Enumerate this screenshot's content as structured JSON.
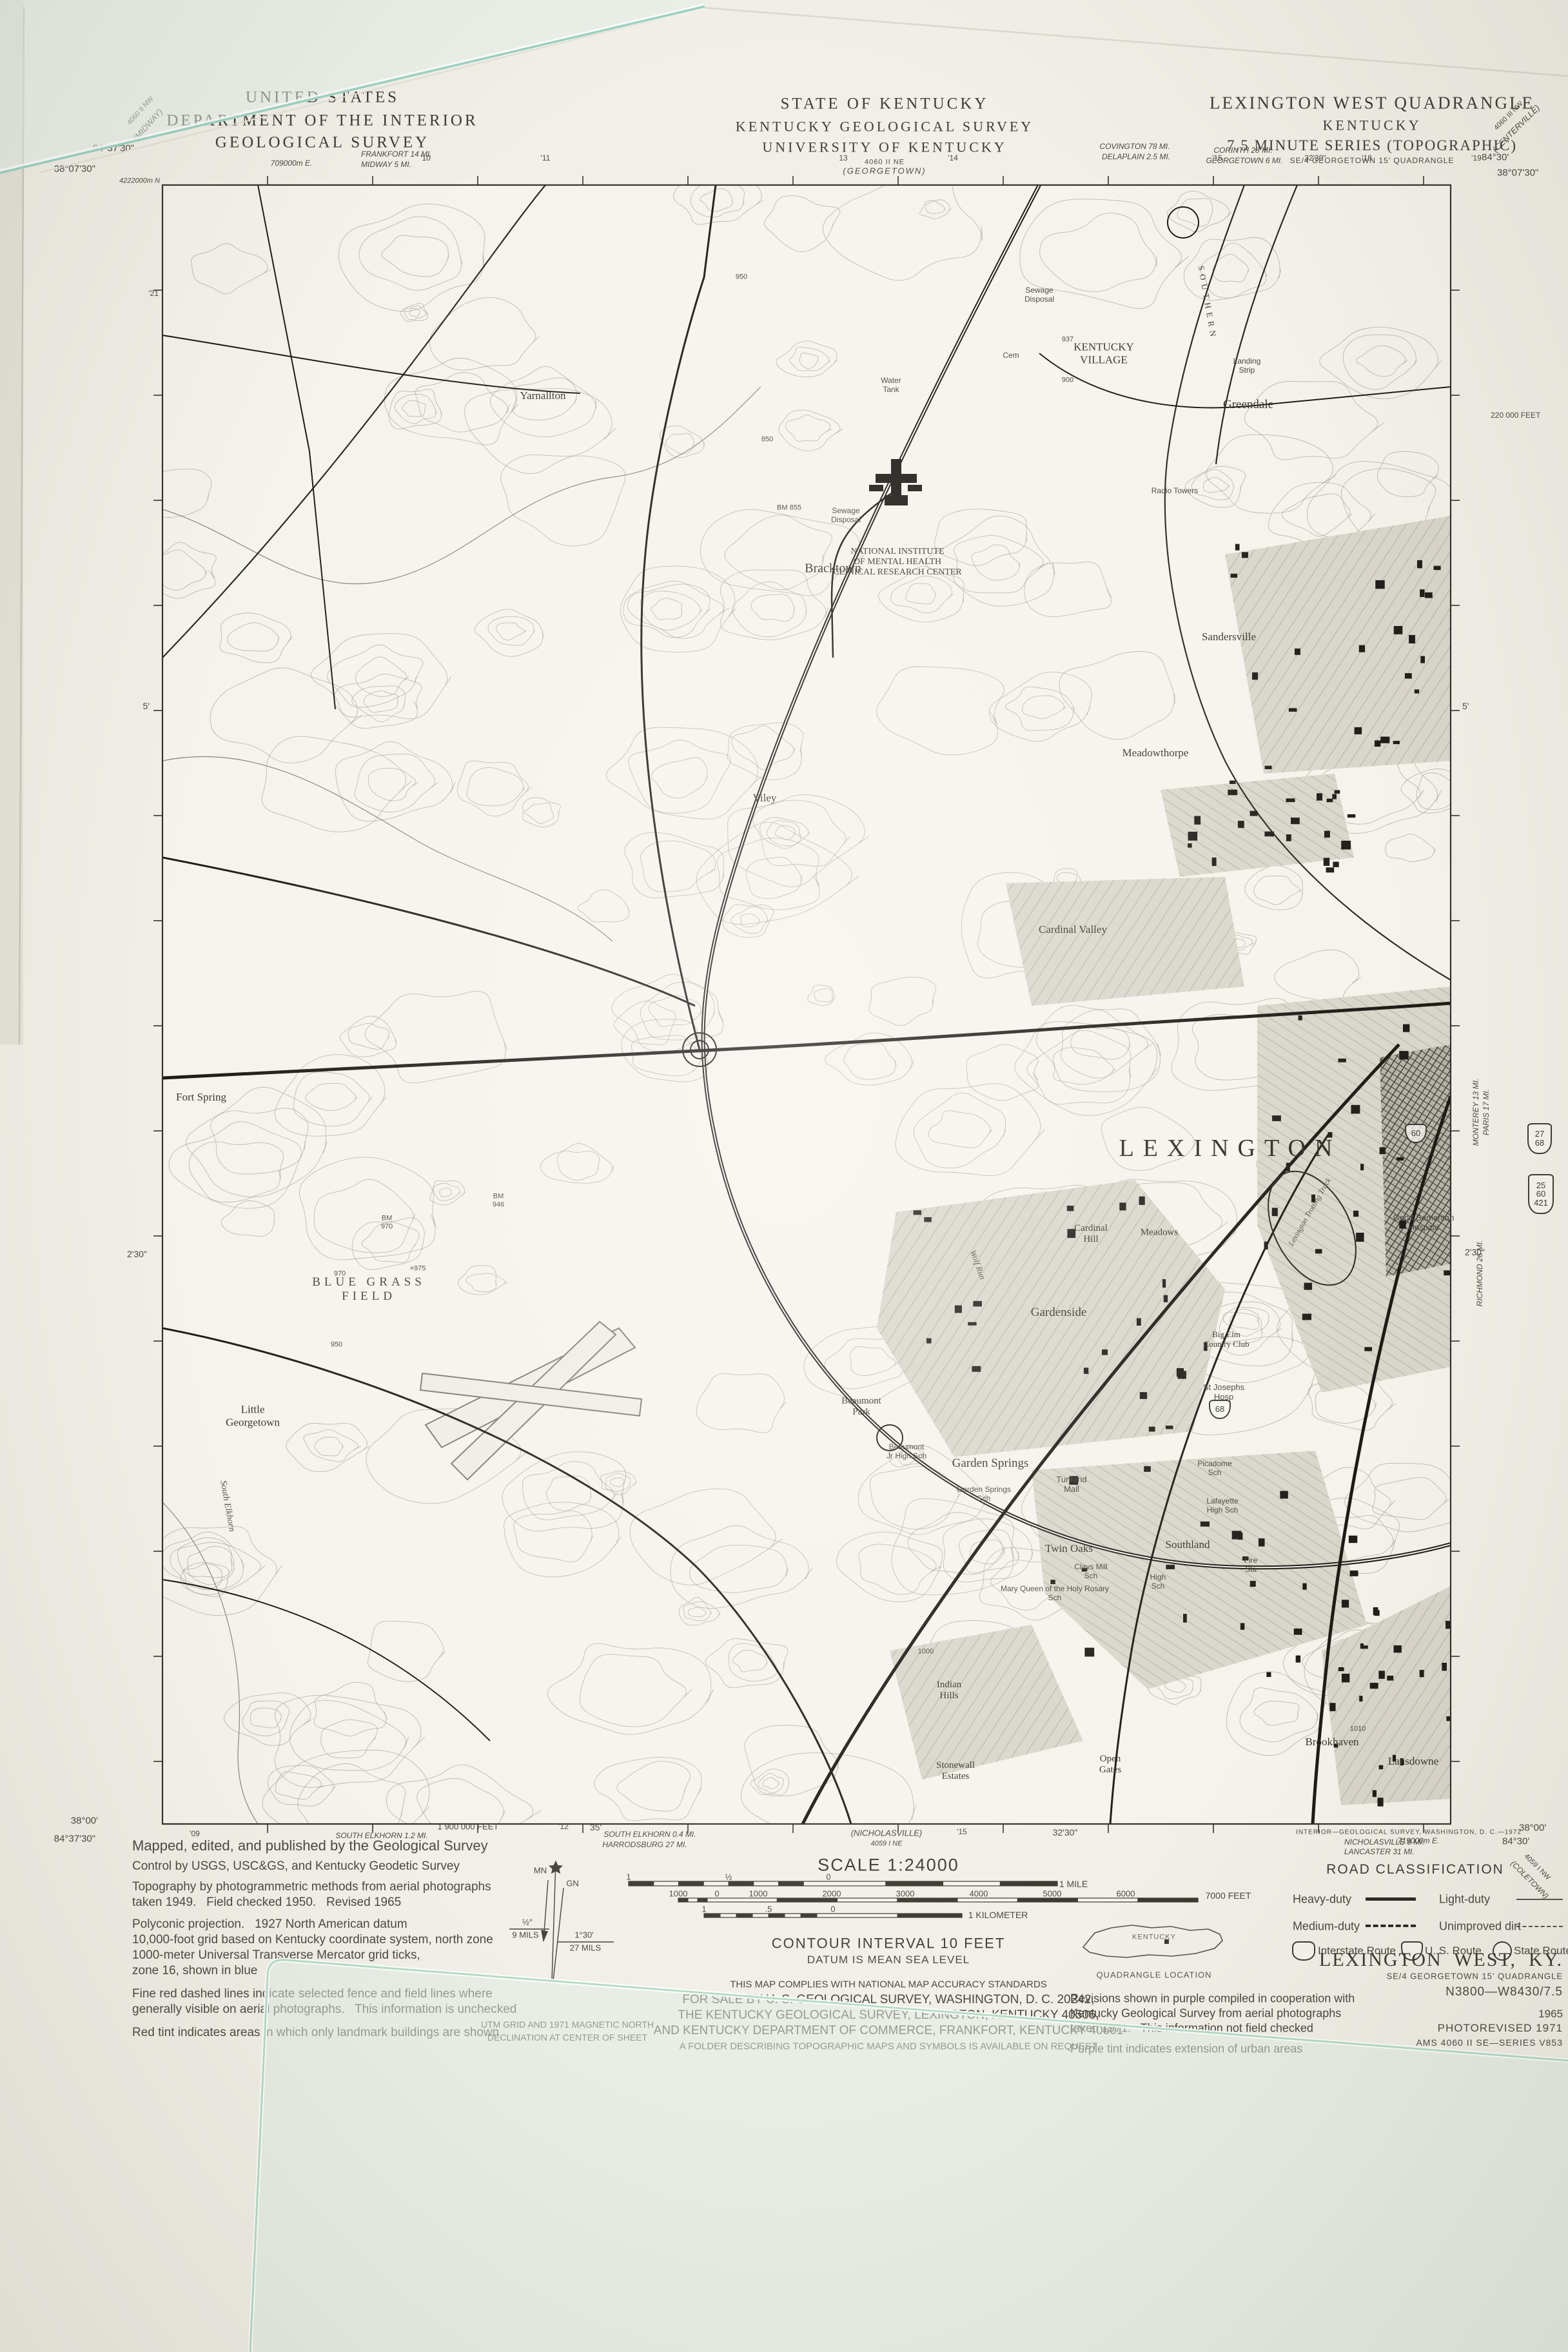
{
  "header": {
    "left": [
      "UNITED STATES",
      "DEPARTMENT OF THE INTERIOR",
      "GEOLOGICAL SURVEY"
    ],
    "center": [
      "STATE OF KENTUCKY",
      "KENTUCKY GEOLOGICAL SURVEY",
      "UNIVERSITY OF KENTUCKY"
    ],
    "right": [
      "LEXINGTON WEST QUADRANGLE",
      "KENTUCKY",
      "7.5 MINUTE SERIES (TOPOGRAPHIC)",
      "SE/4 GEORGETOWN 15' QUADRANGLE"
    ]
  },
  "margin": {
    "nw_lon": "84°37'30\"",
    "nw_lat": "38°07'30\"",
    "utm_easting": "709000m E.",
    "frankfort": "FRANKFORT 14 MI.",
    "midway": "MIDWAY 5 MI.",
    "georgetown_quad_num": "4060 II NE",
    "georgetown_quad": "(GEORGETOWN)",
    "covington": "COVINGTON 78 MI.",
    "delaplain": "DELAPLAIN 2.5 MI.",
    "corinth": "CORINTH 28 MI.",
    "georgetown6": "GEORGETOWN 6 MI.",
    "ne_quad_num": "4060 III NW",
    "ne_quad": "(CENTERVILLE)",
    "ne_lon": "84°30'",
    "ne_lat": "38°07'30\"",
    "midway_quad_num": "4060 II NW",
    "midway_quad": "(MIDWAY)",
    "top_ticks": [
      "'10",
      "'11",
      "13",
      "'14",
      "'15",
      "32'30\"",
      "'18",
      "'19"
    ],
    "left_utm_north": "4222000m N",
    "left_t21": "'21",
    "left_5": "5'",
    "left_230": "2'30\"",
    "right_feet": "220 000 FEET",
    "right_5": "5'",
    "right_230": "2'30\"",
    "monterey": "MONTEREY 13 MI.",
    "paris": "PARIS 17 MI.",
    "richmond": "RICHMOND 26 MI.",
    "sheet_fragments": [
      "U",
      "MI",
      "O"
    ],
    "sw_lat": "38°00'",
    "sw_lon": "84°37'30\"",
    "se_lat": "38°00'",
    "se_lon": "84°30'",
    "b_t09": "'09",
    "south_elkhorn12": "SOUTH ELKHORN 1.2 MI.",
    "feet1900": "1 900 000 FEET",
    "b_t12": "'12",
    "b_35": "35'",
    "south_elkhorn04": "SOUTH ELKHORN 0.4 MI.",
    "harrodsburg": "HARRODSBURG 27 MI.",
    "nicholasville_quad": "(NICHOLASVILLE)",
    "nicholasville_quad_num": "4059 I NE",
    "b_t15": "'15",
    "b_3230": "32'30\"",
    "interior_credit": "INTERIOR—GEOLOGICAL SURVEY, WASHINGTON, D. C.—1972",
    "nicholasville9": "NICHOLASVILLE 9 MI.",
    "lancaster": "LANCASTER 31 MI.",
    "utm719": "719000m E.",
    "se_quad_num": "4059 I NW",
    "se_quad": "(COLETOWN)"
  },
  "credits": {
    "lines": [
      "Mapped, edited, and published by the Geological Survey",
      "Control by USGS, USC&GS, and Kentucky Geodetic Survey",
      "Topography by photogrammetric methods from aerial photographs",
      "taken 1949.   Field checked 1950.   Revised 1965",
      "Polyconic projection.   1927 North American datum",
      "10,000-foot grid based on Kentucky coordinate system, north zone",
      "1000-meter Universal Transverse Mercator grid ticks,",
      "zone 16, shown in blue",
      "Fine red dashed lines indicate selected fence and field lines where",
      "generally visible on aerial photographs.   This information is unchecked",
      "Red tint indicates areas in which only landmark buildings are shown"
    ]
  },
  "declination": {
    "mn": "MN",
    "gn": "GN",
    "left_deg": "½°",
    "left_mils": "9 MILS",
    "right_deg": "1°30'",
    "right_mils": "27 MILS",
    "caption1": "UTM GRID AND 1971 MAGNETIC NORTH",
    "caption2": "DECLINATION AT CENTER OF SHEET"
  },
  "scale_block": {
    "title": "SCALE 1:24000",
    "mile_labels": [
      "1",
      "½",
      "0"
    ],
    "mile_end": "1 MILE",
    "feet_labels": [
      "1000",
      "0",
      "1000",
      "2000",
      "3000",
      "4000",
      "5000",
      "6000"
    ],
    "feet_end": "7000 FEET",
    "km_labels": [
      "1",
      ".5",
      "0"
    ],
    "km_end": "1 KILOMETER",
    "contour": "CONTOUR INTERVAL 10 FEET",
    "datum": "DATUM IS MEAN SEA LEVEL"
  },
  "sale_block": {
    "lines": [
      "THIS MAP COMPLIES WITH NATIONAL MAP ACCURACY STANDARDS",
      "FOR SALE BY U. S. GEOLOGICAL SURVEY, WASHINGTON, D. C. 20242,",
      "THE KENTUCKY GEOLOGICAL SURVEY, LEXINGTON, KENTUCKY 40506,",
      "AND KENTUCKY DEPARTMENT OF COMMERCE, FRANKFORT, KENTUCKY 40601",
      "A FOLDER DESCRIBING TOPOGRAPHIC MAPS AND SYMBOLS IS AVAILABLE ON REQUEST"
    ]
  },
  "quad_location": {
    "state": "KENTUCKY",
    "caption": "QUADRANGLE LOCATION"
  },
  "revision_block": {
    "lines": [
      "Revisions shown in purple compiled in cooperation with",
      "Kentucky Geological Survey from aerial photographs",
      "taken 1971.   This information not field checked",
      "Purple tint indicates extension of urban areas"
    ]
  },
  "road_classification": {
    "title": "ROAD CLASSIFICATION",
    "heavy": "Heavy-duty",
    "medium": "Medium-duty",
    "light": "Light-duty",
    "dirt": "Unimproved dirt",
    "interstate": "Interstate Route",
    "us": "U. S. Route",
    "state": "State Route"
  },
  "title_block": {
    "name": "LEXINGTON  WEST,  KY.",
    "sub": "SE/4 GEORGETOWN 15' QUADRANGLE",
    "code": "N3800—W8430/7.5",
    "year": "1965",
    "photorevised": "PHOTOREVISED 1971",
    "ams": "AMS 4060 II SE—SERIES V853"
  },
  "margin_shields": {
    "s2768": [
      "27",
      "68"
    ],
    "s2560421": [
      "25",
      "60",
      "421"
    ],
    "s60": [
      "60"
    ],
    "s68": [
      "68"
    ]
  },
  "map_labels": {
    "lexington": "LEXINGTON",
    "bracktown": "Bracktown",
    "yarnallton": "Yarnallton",
    "viley": "Viley",
    "sandersville": "Sandersville",
    "greendale": "Greendale",
    "kyvillage": "KENTUCKY\nVILLAGE",
    "nimh": "NATIONAL INSTITUTE\nOF MENTAL HEALTH\nCLINICAL RESEARCH CENTER",
    "watertank": "Water\nTank",
    "sewage1": "Sewage\nDisposal",
    "sewage2": "Sewage\nDisposal",
    "cem": "Cem",
    "landing": "Landing\nStrip",
    "radio": "Radio Towers",
    "southern": "SOUTHERN",
    "bm855": "BM 855",
    "bm937": "937",
    "bluegrass": "BLUE GRASS\nFIELD",
    "bm970": "BM\n970",
    "x975": "×975",
    "bm946": "BM\n946",
    "meadowthorpe": "Meadowthorpe",
    "cardinalvalley": "Cardinal Valley",
    "fortspring": "Fort Spring",
    "littlegeorgetown": "Little\nGeorgetown",
    "southelkhorn": "South Elkhorn",
    "wolfrun": "Wolf Run",
    "gardenside": "Gardenside",
    "cardinalhill": "Cardinal\nHill",
    "meadows": "Meadows",
    "bigelm": "Big Elm\nCountry Club",
    "stjoseph": "St Josephs\nHosp",
    "beaumontpark": "Beaumont\nPark",
    "beaumontjr": "Beaumont\nJr High Sch",
    "gardensprings": "Garden Springs",
    "gssch": "Garden Springs\nSch",
    "turfland": "Turfland\nMall",
    "picadome": "Picadome\nSch",
    "lafayette": "Lafayette\nHigh Sch",
    "goodsam": "Good Samaritan\nHospital",
    "trotting": "Lexington Trotting Track",
    "twinoaks": "Twin Oaks",
    "southland": "Southland",
    "claysmill": "Clays Mill\nSch",
    "maryqueen": "Mary Queen of the Holy Rosary\nSch",
    "highsch": "High\nSch",
    "firesta": "Fire\nSta",
    "opengates": "Open\nGates",
    "stonewall": "Stonewall\nEstates",
    "indianhills": "Indian\nHills",
    "lansdowne": "Lansdowne",
    "brookhaven": "Brookhaven",
    "c900": "900",
    "c950": "950",
    "c850": "850",
    "c970": "970",
    "c950b": "950",
    "c1000": "1000",
    "c1010": "1010"
  }
}
